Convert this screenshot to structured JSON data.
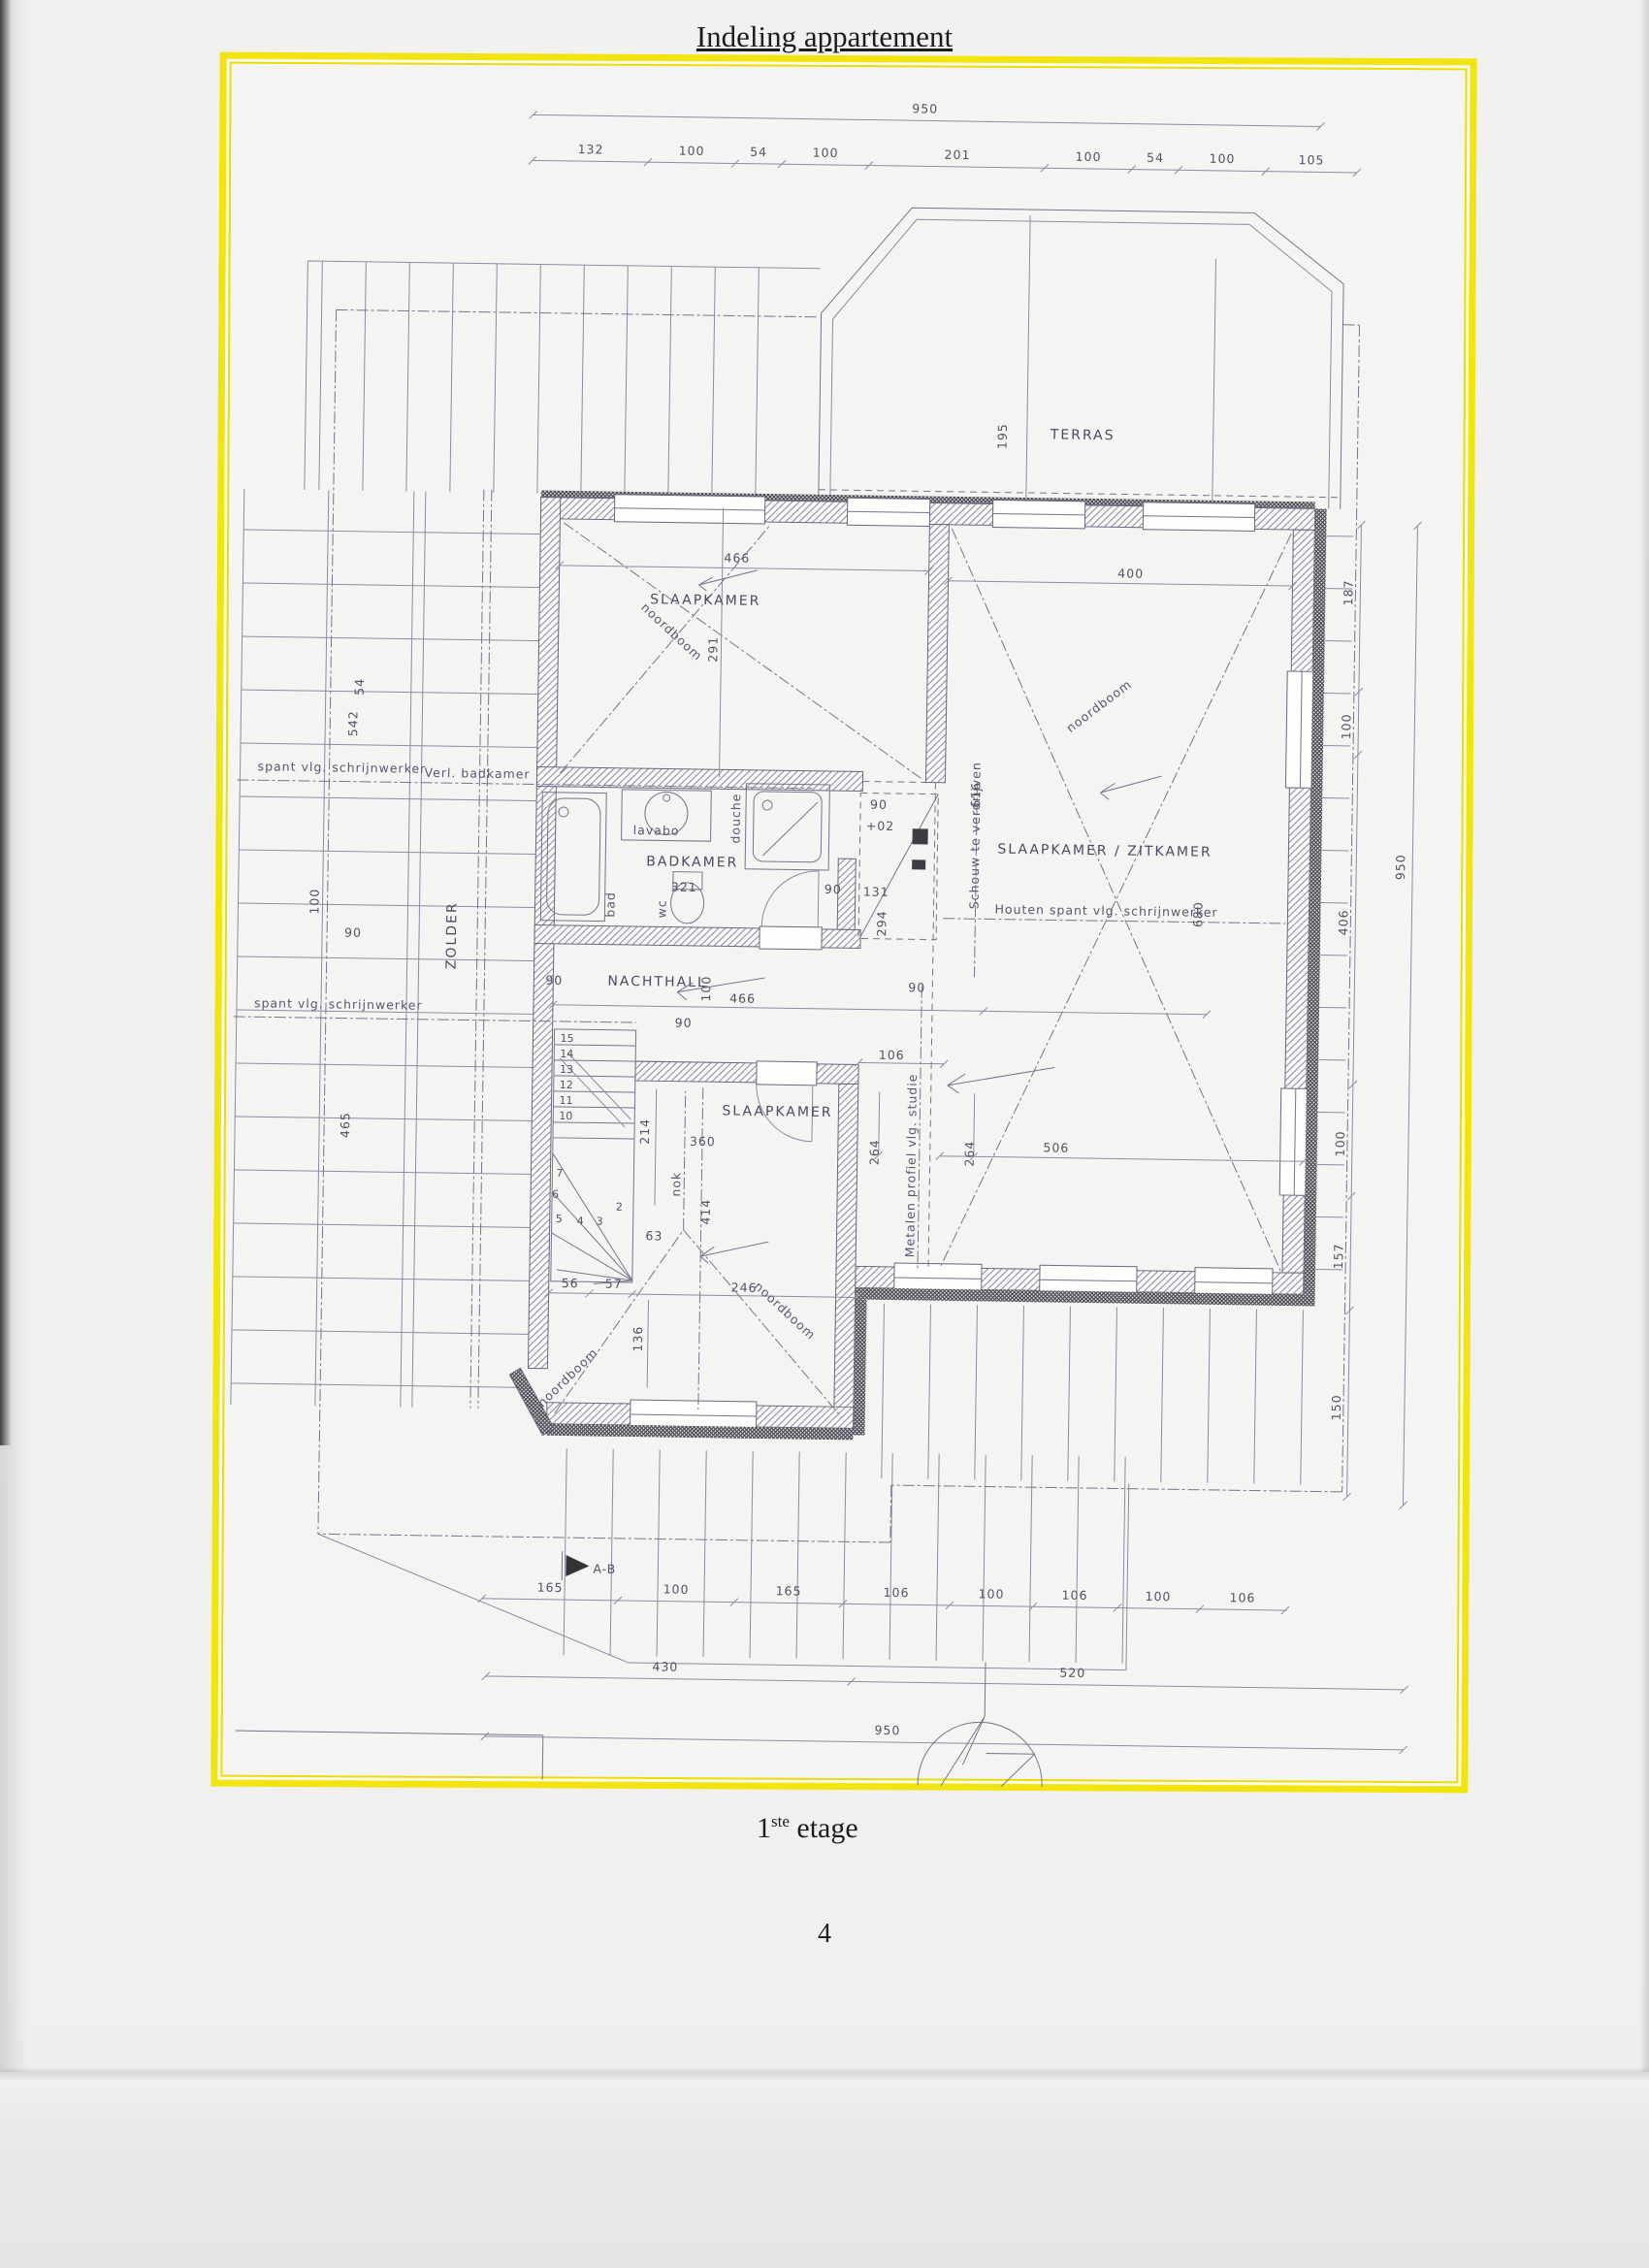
{
  "header": {
    "title": "Indeling appartement"
  },
  "plan": {
    "rooms": {
      "terras": "TERRAS",
      "slaapkamer_top": "SLAAPKAMER",
      "slaapkamer_zitkamer": "SLAAPKAMER / ZITKAMER",
      "badkamer": "BADKAMER",
      "nachthall": "NACHTHALL",
      "slaapkamer_bottom": "SLAAPKAMER",
      "zolder": "ZOLDER"
    },
    "fixtures": {
      "bad": "bad",
      "lavabo": "lavabo",
      "wc": "wc",
      "douche": "douche"
    },
    "notes": {
      "noordboom": "noordboom",
      "nok": "nok",
      "verl_badkamer": "Verl. badkamer",
      "spant": "spant vlg. schrijnwerker",
      "houten_spant": "Houten spant vlg. schrijnwerker",
      "schouw": "Schouw te verdrijven",
      "metalen_profiel": "Metalen profiel vlg. studie",
      "section_marker": "A-B"
    },
    "dims": {
      "top_total": "950",
      "top_segments": [
        "132",
        "100",
        "54",
        "100",
        "201",
        "100",
        "54",
        "100",
        "105"
      ],
      "right_segments": [
        "187",
        "100",
        "406",
        "100",
        "157",
        "150"
      ],
      "right_total": "950",
      "left_54": "54",
      "left_542": "542",
      "left_100": "100",
      "left_90": "90",
      "left_465": "465",
      "bottom_row1": [
        "165",
        "100",
        "165",
        "106",
        "100",
        "106",
        "100",
        "106"
      ],
      "bottom_row2": [
        "430",
        "520"
      ],
      "bottom_total": "950",
      "d466_top": "466",
      "d291": "291",
      "d400": "400",
      "d195": "195",
      "d90": "90",
      "d102": "+02",
      "d321": "321",
      "d131": "131",
      "d294": "294",
      "d616": "616",
      "d680": "680",
      "d100_hall": "100",
      "d466_hall": "466",
      "d106": "106",
      "d214": "214",
      "d360": "360",
      "d264": "264",
      "d506": "506",
      "d63": "63",
      "d56": "56",
      "d57": "57",
      "d246": "246",
      "d136": "136",
      "d414": "414"
    },
    "stairs": {
      "s15": "15",
      "s14": "14",
      "s13": "13",
      "s12": "12",
      "s11": "11",
      "s10": "10",
      "s7": "7",
      "s6": "6",
      "s5": "5",
      "s4": "4",
      "s3": "3",
      "s2": "2"
    }
  },
  "footer": {
    "floor_number": "1",
    "floor_suffix": "ste",
    "floor_word": "etage",
    "page_number": "4",
    "logo_letters": "DIERING"
  }
}
